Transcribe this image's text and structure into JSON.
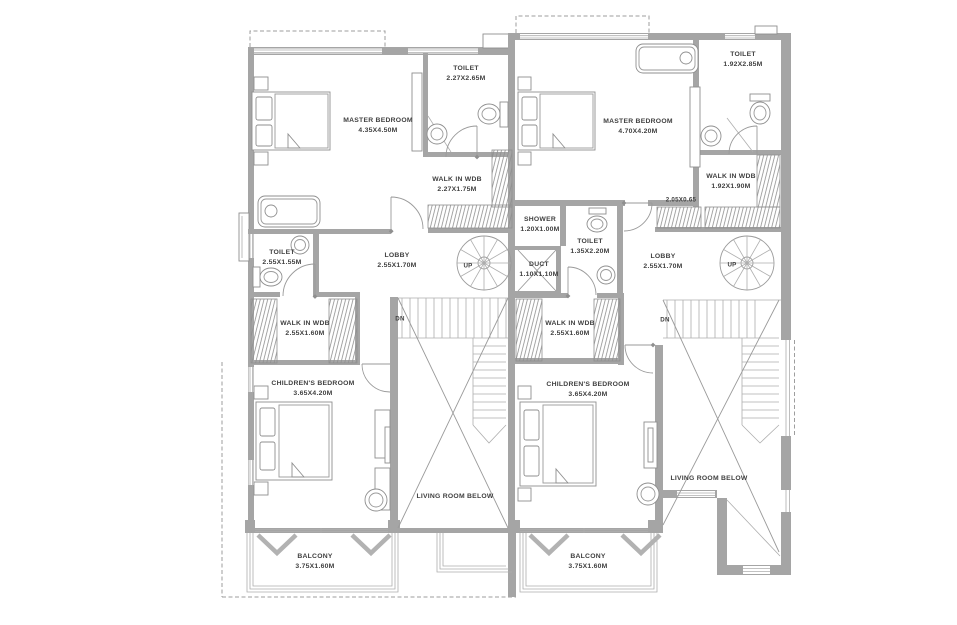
{
  "title": "First floor plan - twin duplex units",
  "colors": {
    "wall": "#a5a5a5",
    "line": "#8f8f8f",
    "thin": "#aeaeae",
    "text": "#3f3f3f",
    "background": "#ffffff"
  },
  "units": {
    "left": {
      "master_bedroom": {
        "name": "MASTER BEDROOM",
        "dims": "4.35X4.50M"
      },
      "toilet_top": {
        "name": "TOILET",
        "dims": "2.27X2.65M"
      },
      "walk_in_wdb_top": {
        "name": "WALK IN WDB",
        "dims": "2.27X1.75M"
      },
      "toilet_mid": {
        "name": "TOILET",
        "dims": "2.55X1.55M"
      },
      "lobby": {
        "name": "LOBBY",
        "dims": "2.55X1.70M"
      },
      "walk_in_wdb": {
        "name": "WALK IN WDB",
        "dims": "2.55X1.60M"
      },
      "childrens_bedroom": {
        "name": "CHILDREN'S BEDROOM",
        "dims": "3.65X4.20M"
      },
      "living_room_below": {
        "name": "LIVING ROOM BELOW"
      },
      "balcony": {
        "name": "BALCONY",
        "dims": "3.75X1.60M"
      },
      "up": "UP",
      "dn": "DN"
    },
    "right": {
      "master_bedroom": {
        "name": "MASTER BEDROOM",
        "dims": "4.70X4.20M"
      },
      "toilet_top": {
        "name": "TOILET",
        "dims": "1.92X2.85M"
      },
      "walk_in_wdb_top": {
        "name": "WALK IN WDB",
        "dims": "1.92X1.90M"
      },
      "wardrobe_dim": "2.05X0.65",
      "shower": {
        "name": "SHOWER",
        "dims": "1.20X1.00M"
      },
      "toilet_mid": {
        "name": "TOILET",
        "dims": "1.35X2.20M"
      },
      "duct": {
        "name": "DUCT",
        "dims": "1.10X1.10M"
      },
      "lobby": {
        "name": "LOBBY",
        "dims": "2.55X1.70M"
      },
      "walk_in_wdb": {
        "name": "WALK IN WDB",
        "dims": "2.55X1.60M"
      },
      "childrens_bedroom": {
        "name": "CHILDREN'S BEDROOM",
        "dims": "3.65X4.20M"
      },
      "living_room_below": {
        "name": "LIVING ROOM BELOW"
      },
      "balcony": {
        "name": "BALCONY",
        "dims": "3.75X1.60M"
      },
      "up": "UP",
      "dn": "DN"
    }
  }
}
